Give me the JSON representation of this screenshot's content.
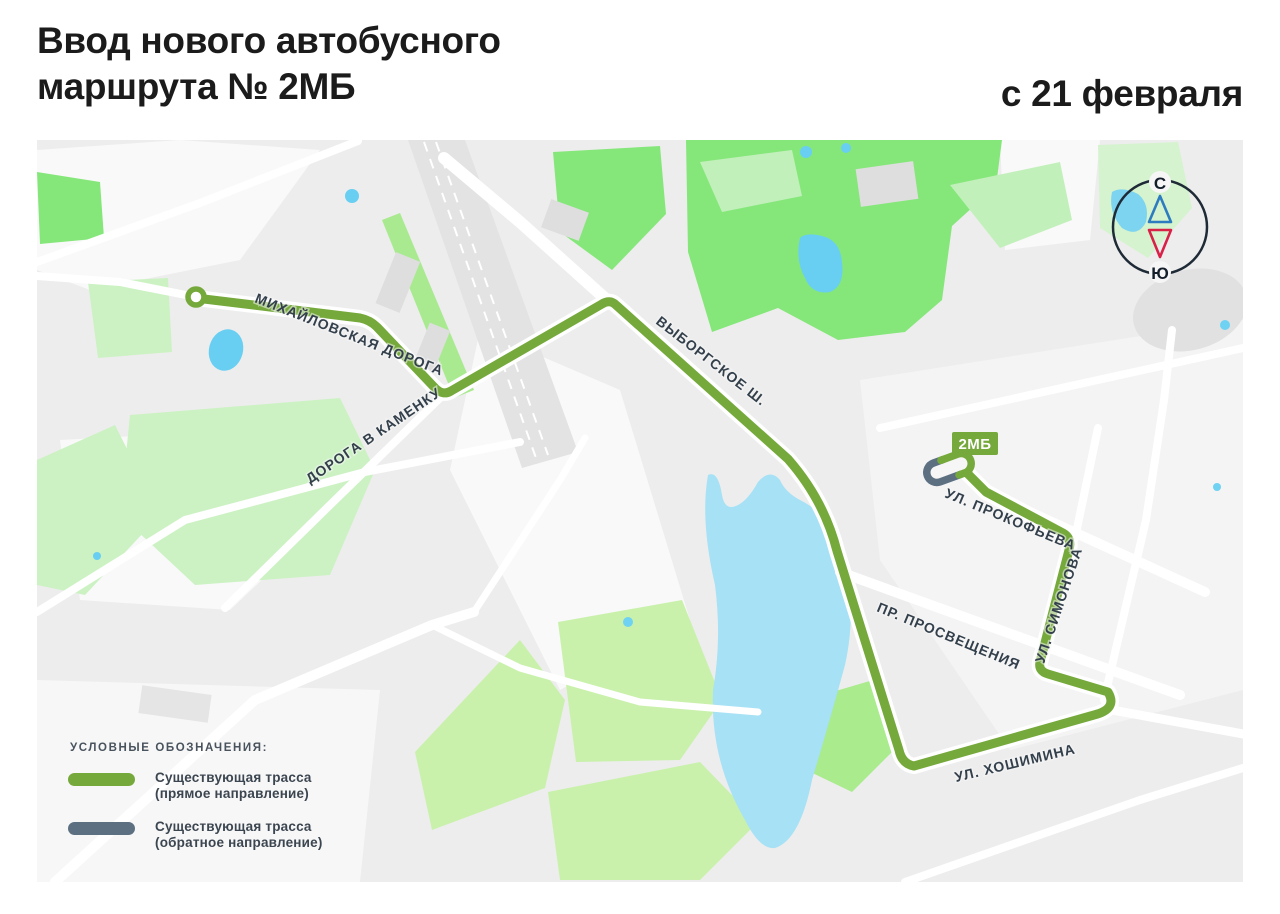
{
  "header": {
    "title_line1": "Ввод нового автобусного",
    "title_line2": "маршрута № 2МБ",
    "effective_date": "с 21 февраля"
  },
  "map": {
    "route_badge_label": "2МБ",
    "compass": {
      "north_label": "С",
      "south_label": "Ю"
    },
    "street_labels": {
      "mikhaylovskaya": "МИХАЙЛОВСКАЯ ДОРОГА",
      "kamenka": "ДОРОГА В КАМЕНКУ",
      "vyborgskoe": "ВЫБОРГСКОЕ Ш.",
      "prokofyeva": "УЛ. ПРОКОФЬЕВА",
      "simonova": "УЛ. СИМОНОВА",
      "prosveshcheniya": "ПР. ПРОСВЕЩЕНИЯ",
      "khoshimina": "УЛ. ХОШИМИНА"
    }
  },
  "legend": {
    "title": "УСЛОВНЫЕ ОБОЗНАЧЕНИЯ:",
    "items": [
      {
        "line1": "Существующая трасса",
        "line2": "(прямое направление)",
        "color": "#76a93c"
      },
      {
        "line1": "Существующая трасса",
        "line2": "(обратное направление)",
        "color": "#5c7082"
      }
    ]
  },
  "colors": {
    "route_forward_green": "#76a93c",
    "route_reverse_gray": "#5c7082",
    "compass_north_triangle_blue": "#2e7cc0",
    "compass_south_triangle_red": "#d92148",
    "park_bright_green": "#85e77a",
    "park_pale_green": "#ccf2c3",
    "water_blue": "#a6e1f5"
  }
}
